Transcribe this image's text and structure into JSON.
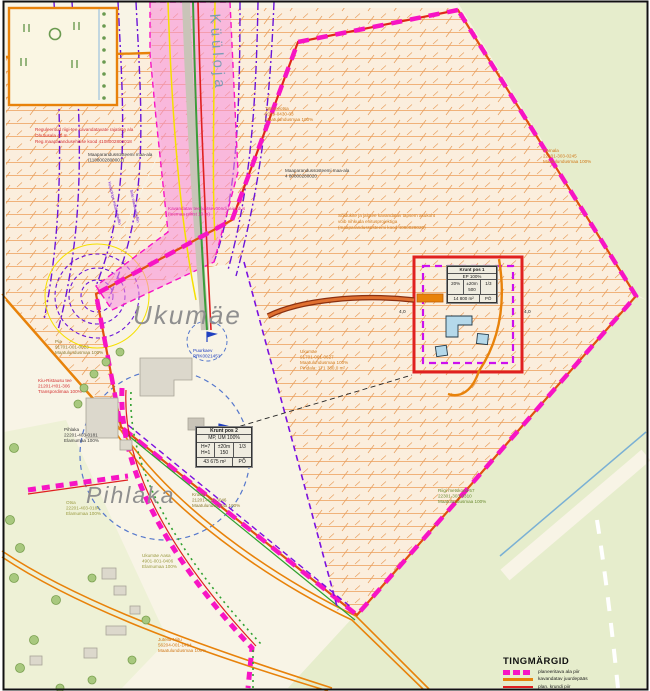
{
  "places": {
    "stream": "Küüloja",
    "ukumae": "Ukumäe",
    "pihlaka": "Pihlaka"
  },
  "labels": {
    "road_note": [
      "Reguleeritud riigi-tee kavandatavate rajatiste ala",
      "Ohutusala 40 m",
      "Reg.maaparandusehitise kood 4108002800018"
    ],
    "drainage1": [
      "Maaparandussüsteemi maa-ala",
      "(1188002800001)"
    ],
    "drainage2": [
      "Maaparandussüsteemi maa-ala",
      "4 80800280020"
    ],
    "corridor_note": [
      "Kavandatav tee kaitsevööndi laiendus",
      "(teemaa piirist 10 m)"
    ],
    "access_note": [
      "Sõidukite ja jalgtee kavandatav täpsem asukoht",
      "võib nihkuda ehitusprojektiga",
      "(maaparandussüsteemi kood 4080028020)"
    ],
    "tammeotsa": [
      "Tammeotsa",
      "2019-0430-03",
      "Maatulundusmaa 100%"
    ],
    "parnala": [
      "Pärnala",
      "22301-303-0245",
      "Maatulundusmaa 100%"
    ],
    "ukumae_parcel": [
      "Ukumäe",
      "91701-001-0627",
      "Maatulundusmaa 100%",
      "Pindala: 171 380,0 m²"
    ],
    "well1": [
      "Puurkaev",
      "PRK0021451"
    ],
    "well2": [
      "Puurkaev",
      "PRK0131451"
    ],
    "kiu_tee": [
      "Kiu-Ristausu tee",
      "21201-H01-306",
      "Transpordimaa 100%"
    ],
    "pihlaka_parcel": [
      "Pihlaka",
      "22201-403-0181",
      "Elamumaa 100%"
    ],
    "pia": [
      "Pia",
      "91701-001-0023",
      "Maatulundusmaa 100%"
    ],
    "kruusi": [
      "Kruusi",
      "21201-H01-3046",
      "Maatulundusmaa 100%"
    ],
    "ukumae_aasa": [
      "Ukumäe Aasa",
      "4901-001-0406",
      "Elamumaa 100%"
    ],
    "jutella": [
      "Jutella Niitu",
      "56204-001-1414",
      "Maatulundusmaa 100%"
    ],
    "metskond": [
      "Riigi metskond 57",
      "22301-303-0310",
      "Maatulundusmaa 100%"
    ],
    "otsa": [
      "Otsa",
      "22201-403-0184",
      "Elamumaa 100%"
    ],
    "utility1": "Keskpinge maakaabelliin",
    "utility2": "Side maakaabelliin",
    "dim1": "4,0",
    "dim2": "4,0"
  },
  "tables": {
    "pos1": {
      "title": "Krunt pos 1",
      "use": "EP 100%",
      "c1": "20%",
      "c2": "±20m 500",
      "c3": "1/3",
      "area": "14 800 m²",
      "code": "PÕ"
    },
    "pos2": {
      "title": "Krunt pos 2",
      "use": "MP, ÜM 100%",
      "c1": "H=7 H=1",
      "c2": "±20m 150",
      "c3": "1/3",
      "area": "43 675 m²",
      "code": "PÕ"
    }
  },
  "legend": {
    "title": "TINGMÄRGID",
    "items": [
      {
        "name": "planned-area-boundary",
        "label": "planeeritava ala piir"
      },
      {
        "name": "planned-access",
        "label": "kavandatav juurdepääs"
      },
      {
        "name": "planned-plot-boundary",
        "label": "plan. krundi piir"
      },
      {
        "name": "planned-light-traffic-road",
        "label": "kavandatav kergliiklustee"
      }
    ]
  },
  "colors": {
    "boundary_magenta": "#f714c4",
    "access_orange": "#e8820a",
    "plot_red": "#e02020",
    "utility_purple": "#6b14d8",
    "hatch_orange": "#f0b27a",
    "forest_green": "#e6edcc",
    "field_cream": "#f8f4e6",
    "corridor_pink": "#f78cdb"
  }
}
